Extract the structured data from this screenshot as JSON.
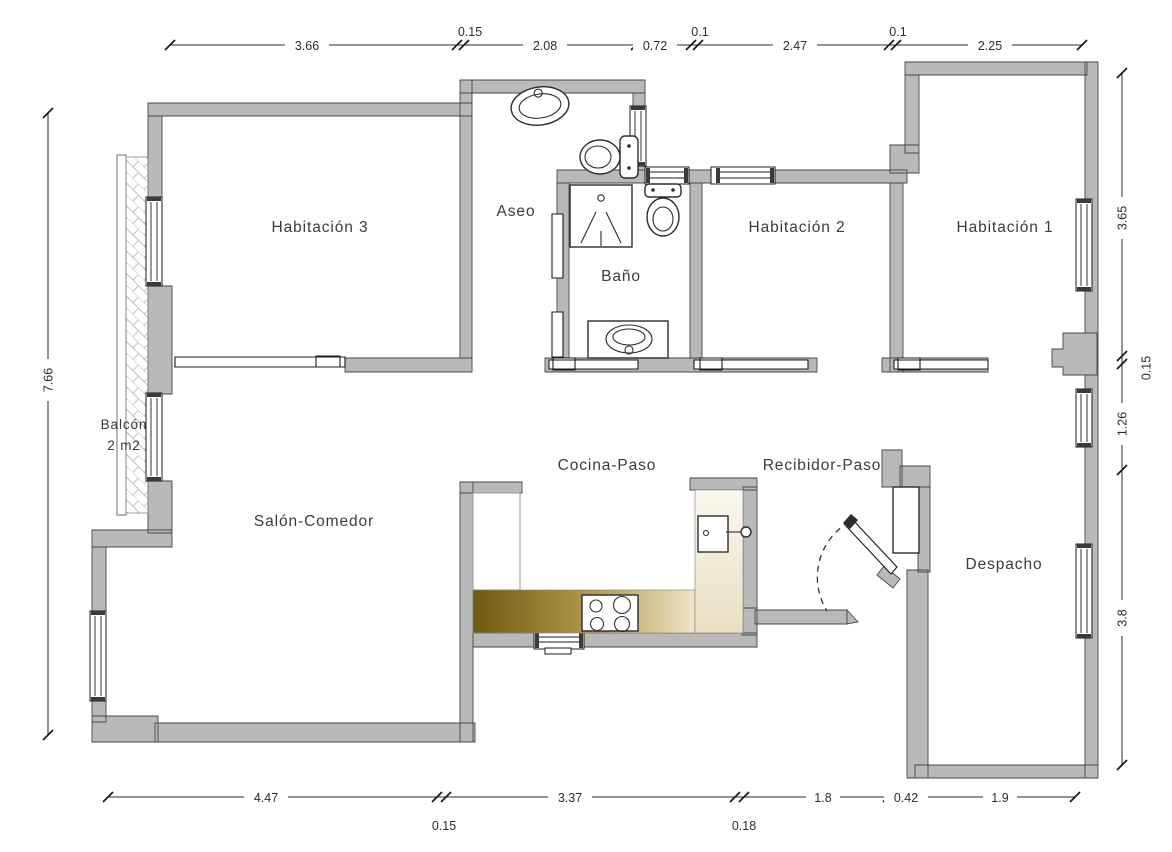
{
  "rooms": {
    "habitacion3": "Habitación 3",
    "aseo": "Aseo",
    "bano": "Baño",
    "habitacion2": "Habitación 2",
    "habitacion1": "Habitación 1",
    "balcon": "Balcón",
    "balcon_area": "2 m2",
    "salon_comedor": "Salón-Comedor",
    "cocina_paso": "Cocina-Paso",
    "recibidor_paso": "Recibidor-Paso",
    "despacho": "Despacho"
  },
  "dimensions": {
    "top": [
      "3.66",
      "0.15",
      "2.08",
      "0.72",
      "0.1",
      "2.47",
      "0.1",
      "2.25"
    ],
    "bottom": [
      "4.47",
      "0.15",
      "3.37",
      "0.18",
      "1.8",
      "0.42",
      "1.9"
    ],
    "left": [
      "7.66"
    ],
    "right": [
      "3.65",
      "0.15",
      "1.26",
      "3.8"
    ]
  },
  "fixtures": [
    "sink",
    "toilet",
    "shower",
    "washbasin",
    "stove",
    "kitchen-sink",
    "entrance-door",
    "closet-niche"
  ],
  "colors": {
    "wall": "#b9b9b9",
    "wall_outline": "#474747",
    "counter_dark": "#6e5a10",
    "counter_mid": "#b49a4e",
    "counter_light": "#efe5c9",
    "strip_light": "#faf7ee",
    "strip_dark": "#e9dfc2",
    "line": "#2d2d2d",
    "background": "#ffffff"
  }
}
